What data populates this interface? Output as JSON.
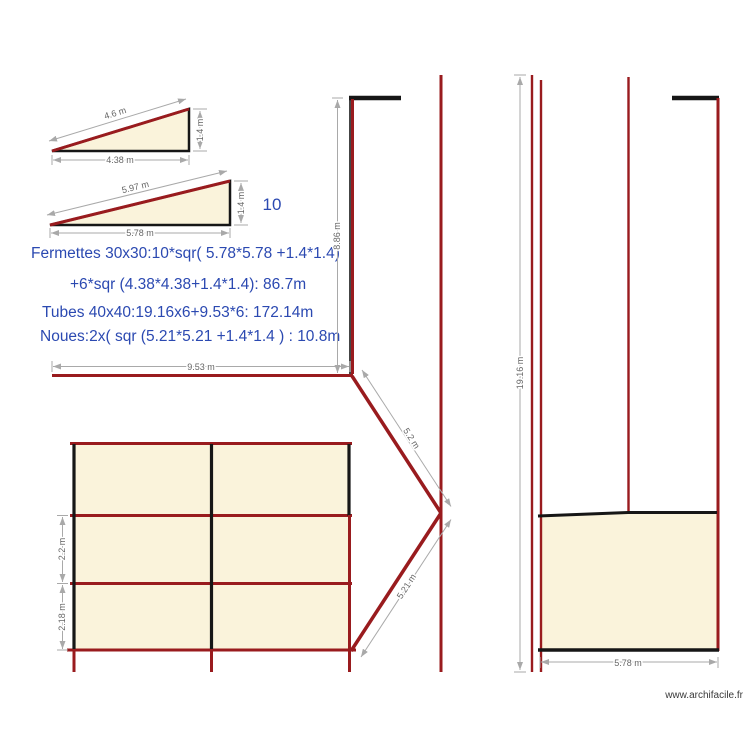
{
  "colors": {
    "wall_red": "#991B1E",
    "wall_black": "#161616",
    "roof_fill_cream": "#FAF3DB",
    "dimension_line_gray": "#A9A9A9",
    "dimension_text_gray": "#666666",
    "note_blue": "#2B49B1",
    "watermark_text": "#3A3A3A",
    "background": "#FFFFFF"
  },
  "triangle_small": {
    "hypotenuse": "4.6 m",
    "height": "1.4 m",
    "base": "4.38 m"
  },
  "triangle_large": {
    "hypotenuse": "5.97 m",
    "height": "1.4 m",
    "base": "5.78 m"
  },
  "notes": {
    "count": "10",
    "line1": "Fermettes 30x30:10*sqr( 5.78*5.78 +1.4*1.4)",
    "line2": "+6*sqr (4.38*4.38+1.4*1.4): 86.7m",
    "line3": "Tubes 40x40:19.16x6+9.53*6: 172.14m",
    "line4": "Noues:2x( sqr (5.21*5.21 +1.4*1.4 ) : 10.8m"
  },
  "main_plan": {
    "width": "9.53 m",
    "left_height": "8.86 m",
    "noue_upper": "5.2 m",
    "noue_lower": "5.21 m",
    "row_middle_height": "2.2 m",
    "row_bottom_height": "2.18 m"
  },
  "right_plan": {
    "total_height": "19.16 m",
    "base_width": "5.78 m"
  },
  "watermark": {
    "label": "www.archifacile.fr"
  }
}
